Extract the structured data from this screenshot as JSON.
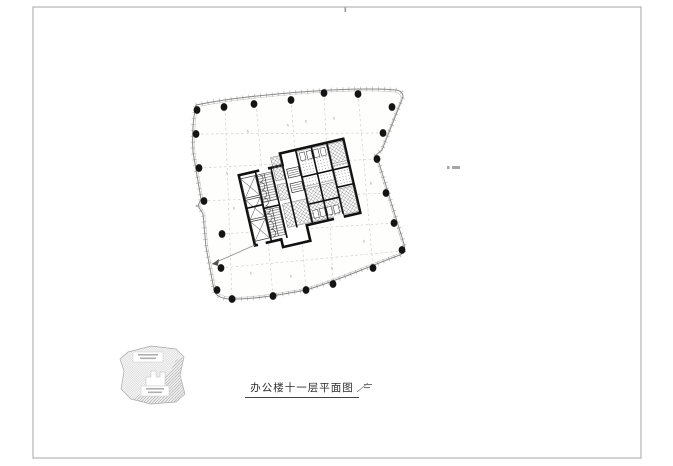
{
  "page": {
    "background": "#ffffff",
    "frame": {
      "x": 33,
      "y": 7,
      "w": 608,
      "h": 451,
      "color": "#b3b3b3"
    },
    "fold_tick": {
      "x": 344.5,
      "y": 7.5,
      "w": 1.6,
      "h": 4.5,
      "color": "#999999"
    }
  },
  "title_block": {
    "title": "办公楼十一层平面图"
  },
  "drawing": {
    "facade_color": "#8a8a8a",
    "tick_color": "#9a9a9a",
    "inner_line_color": "#c6c6c6",
    "fill_color": "#fefefd",
    "column_color": "#141414",
    "grid_color": "#cfcfcf",
    "outline_path": "M196,105 C230,98 265,95 300,92 C335,89 375,88 396,90 Q403,91 403,97 L382,150 L375,156 L379,163 C386,186 395,214 404,244 Q406,252 400,255 C372,265 340,280 306,290 C280,295 250,300 229,299 Q216,298 214,290 L206,247 L203,214 L198,206 L201,199 L193,152 C192,136 193,119 196,105 Z",
    "columns": [
      [
        197,
        110
      ],
      [
        224,
        107
      ],
      [
        254,
        104
      ],
      [
        291,
        100
      ],
      [
        324,
        93
      ],
      [
        358,
        94
      ],
      [
        392,
        107
      ],
      [
        383,
        133
      ],
      [
        377,
        159
      ],
      [
        386,
        193
      ],
      [
        394,
        223
      ],
      [
        402,
        250
      ],
      [
        373,
        268
      ],
      [
        333,
        284
      ],
      [
        306,
        290
      ],
      [
        273,
        296
      ],
      [
        232,
        299
      ],
      [
        217,
        290
      ],
      [
        221,
        268
      ],
      [
        222,
        234
      ],
      [
        204,
        201
      ],
      [
        199,
        168
      ],
      [
        196,
        134
      ]
    ],
    "grid_vertical": [
      [
        225,
        108,
        232,
        298
      ],
      [
        256,
        104,
        273,
        296
      ],
      [
        291,
        100,
        306,
        290
      ],
      [
        324,
        93,
        333,
        284
      ],
      [
        358,
        94,
        373,
        268
      ]
    ],
    "grid_horizontal": [
      [
        196,
        134,
        383,
        133
      ],
      [
        199,
        168,
        377,
        159
      ],
      [
        203,
        201,
        386,
        193
      ],
      [
        221,
        234,
        394,
        223
      ],
      [
        221,
        268,
        402,
        251
      ]
    ],
    "bay_tags": [
      [
        247,
        130
      ],
      [
        287,
        124
      ],
      [
        333,
        117
      ],
      [
        226,
        172
      ],
      [
        233,
        207
      ],
      [
        250,
        272
      ],
      [
        290,
        275
      ],
      [
        331,
        267
      ],
      [
        363,
        240
      ],
      [
        370,
        182
      ],
      [
        305,
        120
      ]
    ],
    "leader": {
      "from": [
        255,
        245
      ],
      "to": [
        212,
        264
      ],
      "arrow": [
        [
          212,
          264
        ],
        [
          219,
          259
        ],
        [
          218,
          266
        ]
      ]
    }
  },
  "core": {
    "rotation": "-13 300 196",
    "wall_color": "#111111",
    "outer_path": "M245,162 H290 V150 H355 V226 H300 V242 H272 V234 H245 Z",
    "wall_segments": [
      "M262,162 V234",
      "M278,162 V234",
      "M290,162 V226",
      "M306,150 V226",
      "M322,150 V226",
      "M338,150 V226",
      "M262,200 H278",
      "M306,178 H355",
      "M306,206 H338",
      "M338,196 H355",
      "M245,196 H262"
    ],
    "scallop_path": "M264,166 a4,4 0 0 1 0,8 a4,4 0 0 1 0,8 a4,4 0 0 1 0,8 a4,4 0 0 1 0,8 a4,4 0 0 1 0,8 a4,4 0 0 1 0,8 a4,4 0 0 1 0,8 a4,4 0 0 1 0,8",
    "x_cells": [
      [
        246,
        166,
        15,
        20
      ],
      [
        246,
        188,
        15,
        20
      ],
      [
        246,
        210,
        15,
        20
      ]
    ],
    "tread_cells": [
      [
        263,
        166,
        14,
        28
      ],
      [
        263,
        202,
        14,
        28
      ]
    ],
    "hatch_cells": [
      [
        280,
        152,
        9,
        24
      ],
      [
        280,
        180,
        9,
        16
      ],
      [
        281,
        200,
        24,
        24
      ],
      [
        339,
        152,
        15,
        20
      ],
      [
        339,
        198,
        15,
        26
      ],
      [
        307,
        190,
        31,
        34
      ]
    ],
    "dot_cells": [
      [
        307,
        152,
        30,
        36
      ],
      [
        339,
        174,
        15,
        22
      ]
    ],
    "flight_boxes": [
      [
        293,
        167,
        12,
        9
      ],
      [
        293,
        182,
        12,
        9
      ]
    ],
    "stall_rows": [
      {
        "x": 309,
        "y": 154,
        "n": 4,
        "dx": 7,
        "w": 5,
        "h": 8
      },
      {
        "x": 309,
        "y": 213,
        "n": 4,
        "dx": 7,
        "w": 5,
        "h": 8
      }
    ],
    "door_gaps": [
      [
        266,
        159,
        9,
        5
      ],
      [
        328,
        223,
        10,
        5
      ],
      [
        248,
        231,
        8,
        5
      ]
    ]
  },
  "keyplan": {
    "outline_path": "M128,352 L151,346 L176,349 L184,357 L180,375 L185,394 L176,402 L151,404 L131,399 L121,389 L124,371 L120,359 Z",
    "dark_region_path": "M184,357 L180,375 L185,394 L176,402 L151,404 L133,399 L158,382 L170,372 L176,360 Z",
    "core_notch_path": "M146,386 L146,377 L151,377 L151,371 L156,371 L156,377 L160,377 L160,372 L165,372 L165,386 Z",
    "outline_color": "#aaaaaa",
    "label_boxes": [
      [
        133,
        352,
        30,
        10
      ],
      [
        141,
        386,
        28,
        10
      ]
    ],
    "label_smudges": [
      [
        138,
        354,
        20
      ],
      [
        140,
        357.5,
        16
      ],
      [
        146,
        388,
        18
      ],
      [
        148,
        391.5,
        14
      ]
    ]
  },
  "annotations": {
    "scale_mark": {
      "slash": "M357,392 L368,383",
      "bars": [
        [
          364,
          384,
          8,
          1.1
        ],
        [
          364,
          387,
          6,
          1.1
        ]
      ],
      "color": "#777777"
    },
    "right_micro_text": {
      "rects": [
        [
          447,
          166,
          2.5,
          3
        ],
        [
          452,
          166,
          8,
          3
        ]
      ],
      "color": "#979797"
    }
  }
}
